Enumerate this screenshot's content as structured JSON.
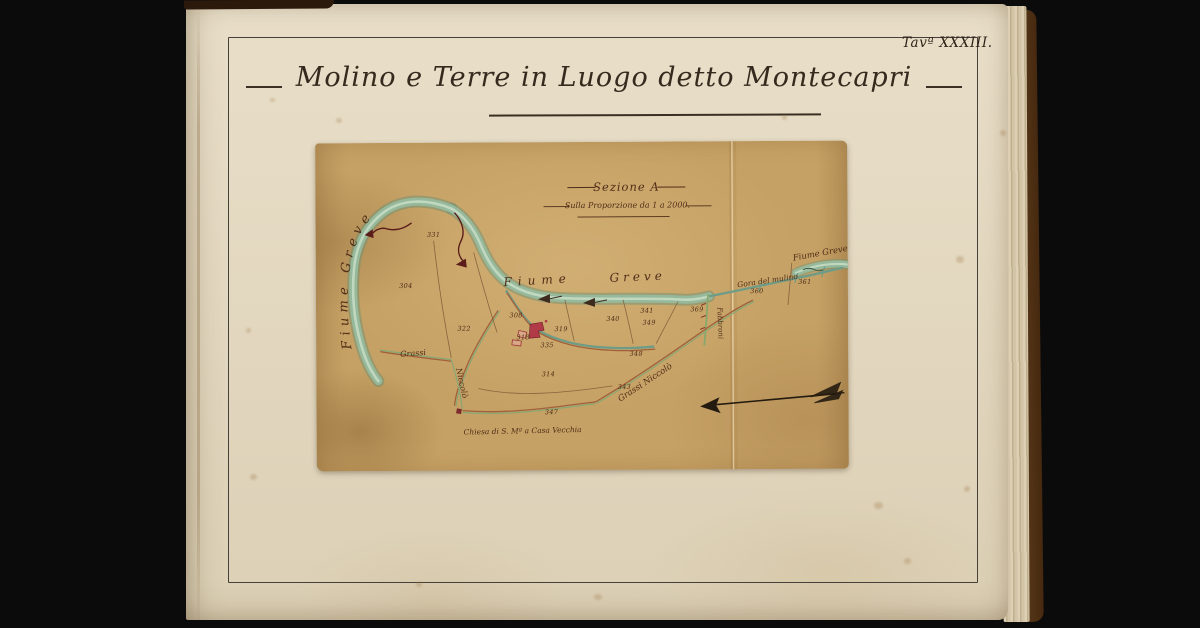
{
  "page": {
    "plate_label": "Tavª XXXIII.",
    "title": "Molino e Terre in Luogo detto Montecapri"
  },
  "map": {
    "heading": {
      "section": "Sezione A",
      "scale": "Sulla Proporzione da 1 a 2000."
    },
    "labels": {
      "river_left": "Fiume Greve",
      "river_center_a": "Fiume",
      "river_center_b": "Greve",
      "river_right": "Fiume Greve",
      "mill_channel": "Gora del mulino",
      "owner_left_a": "Grassi",
      "owner_left_b": "Niccolò",
      "owner_right_road": "Grassi Niccolò",
      "owner_right_vertical": "Fabbroni",
      "church": "Chiesa di S. Mª a Casa Vecchia"
    },
    "parcels": [
      {
        "n": "331"
      },
      {
        "n": "304"
      },
      {
        "n": "322"
      },
      {
        "n": "308"
      },
      {
        "n": "318"
      },
      {
        "n": "335"
      },
      {
        "n": "319"
      },
      {
        "n": "340"
      },
      {
        "n": "341"
      },
      {
        "n": "349"
      },
      {
        "n": "369"
      },
      {
        "n": "348"
      },
      {
        "n": "314"
      },
      {
        "n": "343"
      },
      {
        "n": "347"
      },
      {
        "n": "360"
      },
      {
        "n": "361"
      }
    ],
    "colors": {
      "map_paper": "#c6a165",
      "page_paper": "#e6dcc8",
      "river": "#96bb9e",
      "road_green": "#8aa773",
      "road_sienna": "#a2603a",
      "mill_red": "#b13a47",
      "ink": "#4f2d18"
    }
  }
}
